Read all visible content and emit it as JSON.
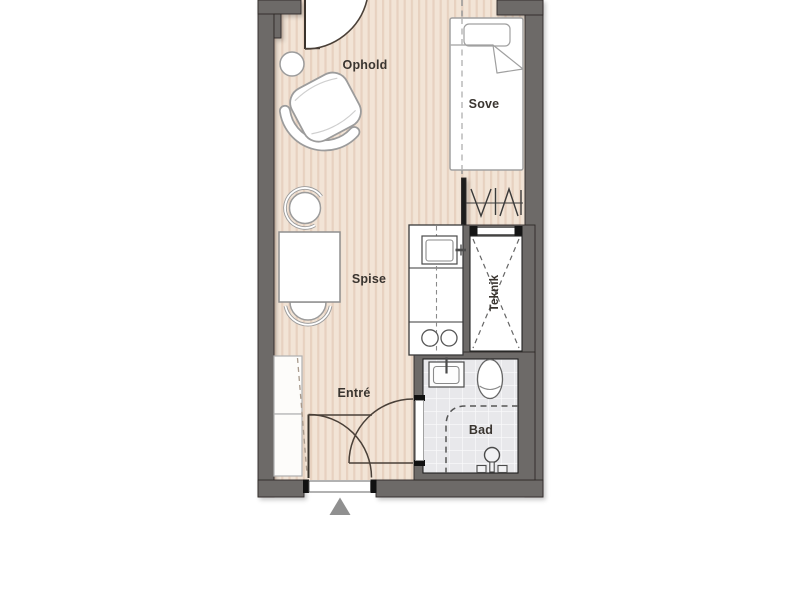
{
  "plan": {
    "type": "apartment-floor-plan",
    "rooms": {
      "ophold": {
        "label": "Ophold"
      },
      "sove": {
        "label": "Sove"
      },
      "spise": {
        "label": "Spise"
      },
      "teknik": {
        "label": "Teknik"
      },
      "entre": {
        "label": "Entré"
      },
      "bad": {
        "label": "Bad"
      }
    },
    "colors": {
      "wall": "#6d6a68",
      "wall_outline": "#2e2a28",
      "floor_base": "#f2e4d6",
      "floor_stripe": "#e7d1c0",
      "bath_tile": "#e8e8eb",
      "tile_grout": "#f9f9fa",
      "furniture_outline": "#9c9c9c",
      "fixture_outline": "#4a4a4a",
      "door_arc": "#4a4038",
      "dashed_line": "#999999",
      "label_text": "#3a3530",
      "entry_marker": "#909090"
    },
    "icons": {
      "entry_marker": "triangle-up",
      "wardrobe": "hanger-rail-marks",
      "teknik_shaft": "x-cross-dashed",
      "shower": "shower-head-icon"
    }
  }
}
